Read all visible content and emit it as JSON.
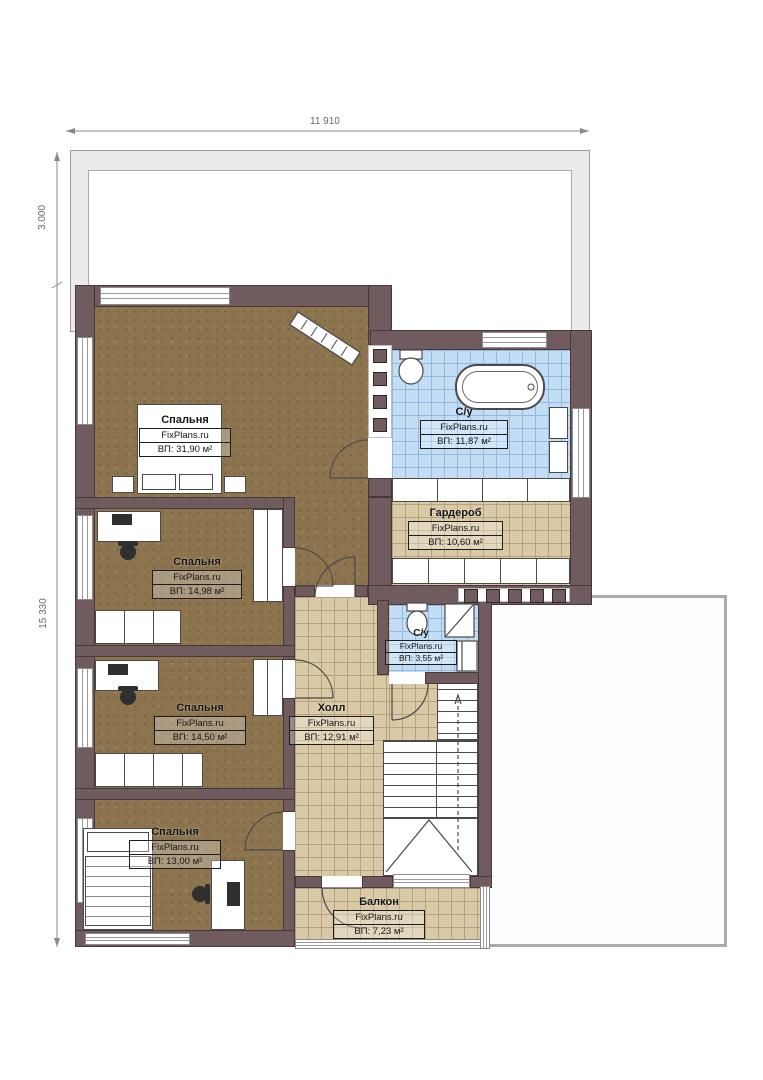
{
  "plan": {
    "type": "floor-plan",
    "language": "ru",
    "branding": "FixPlans.ru"
  },
  "dimensions": {
    "top_width": "11 910",
    "left_upper": "3.000",
    "left_lower": "15 330"
  },
  "rooms": [
    {
      "id": "bedroom-1",
      "name": "Спальня",
      "brand": "FixPlans.ru",
      "area": "ВП: 31,90 м²"
    },
    {
      "id": "bathroom-1",
      "name": "С/у",
      "brand": "FixPlans.ru",
      "area": "ВП: 11,87 м²"
    },
    {
      "id": "wardrobe",
      "name": "Гардероб",
      "brand": "FixPlans.ru",
      "area": "ВП: 10,60 м²"
    },
    {
      "id": "bedroom-2",
      "name": "Спальня",
      "brand": "FixPlans.ru",
      "area": "ВП: 14,98 м²"
    },
    {
      "id": "bathroom-2",
      "name": "С/у",
      "brand": "FixPlans.ru",
      "area": "ВП: 3,55 м²"
    },
    {
      "id": "bedroom-3",
      "name": "Спальня",
      "brand": "FixPlans.ru",
      "area": "ВП: 14,50 м²"
    },
    {
      "id": "hall",
      "name": "Холл",
      "brand": "FixPlans.ru",
      "area": "ВП: 12,91 м²"
    },
    {
      "id": "bedroom-4",
      "name": "Спальня",
      "brand": "FixPlans.ru",
      "area": "ВП: 13,00 м²"
    },
    {
      "id": "balcony",
      "name": "Балкон",
      "brand": "FixPlans.ru",
      "area": "ВП: 7,23 м²"
    }
  ],
  "colors": {
    "wall": "#705b5e",
    "wood_floor": "#8b744e",
    "beige_tile": "#d9c9a6",
    "blue_tile": "#c2ddf4",
    "roof": "#ebebeb"
  }
}
